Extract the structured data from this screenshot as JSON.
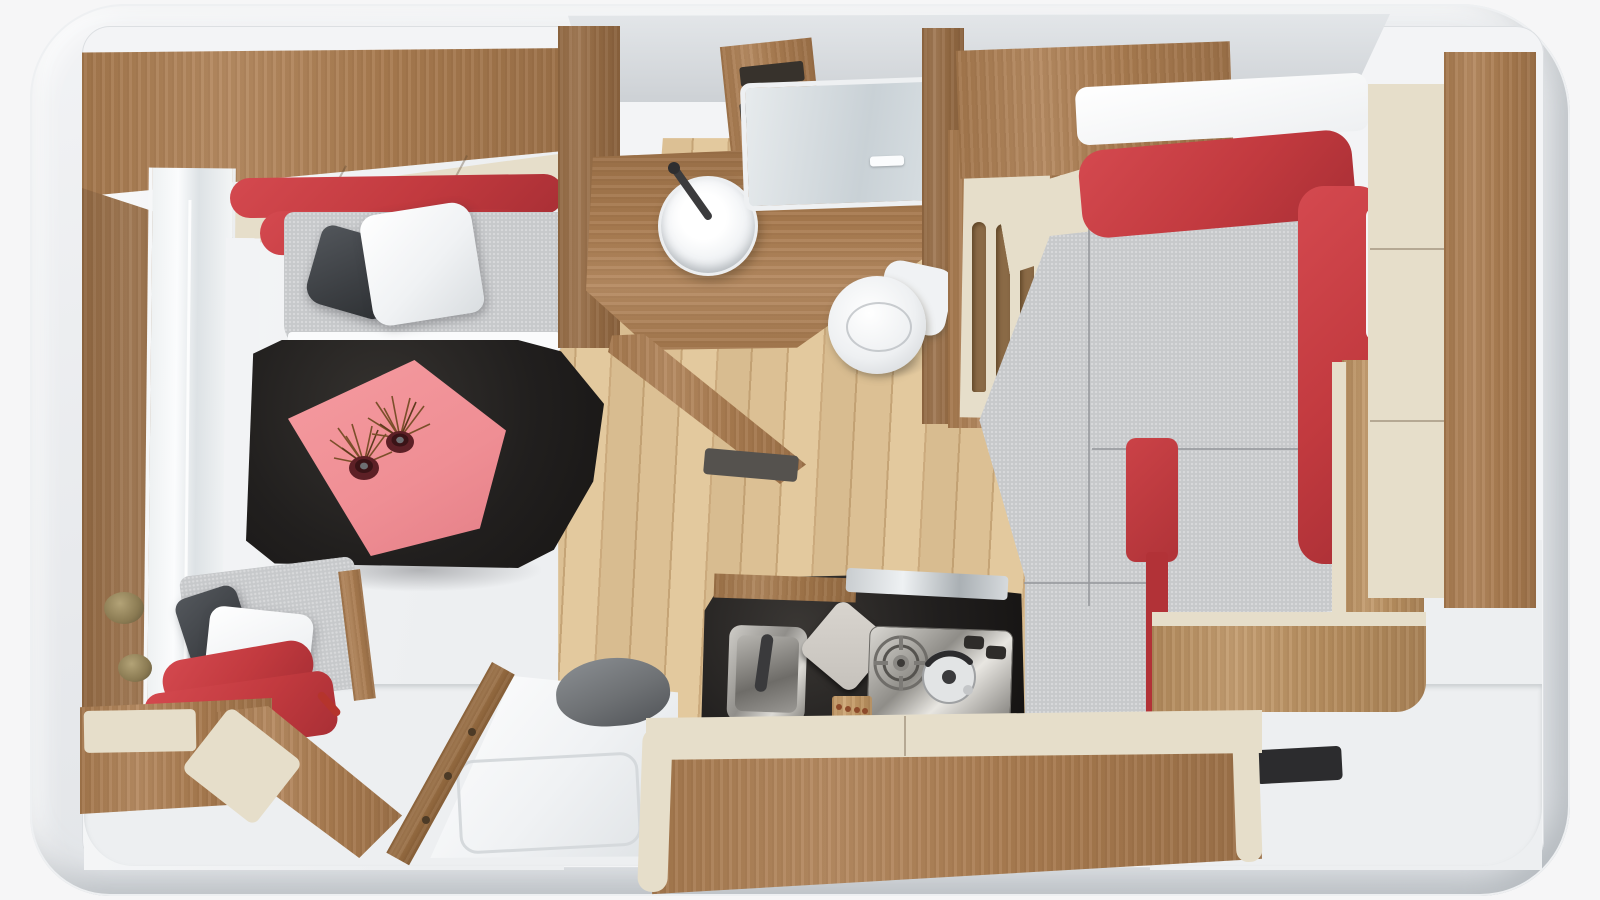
{
  "scene": {
    "label": "caravan-interior-top-down-render",
    "view": "top-down cutaway 3D render",
    "regions": {
      "lounge": {
        "label": "front dinette lounge with two facing bench seats and table",
        "objects": [
          "overhead-lockers-wood",
          "overhead-locker-doors-cream",
          "front-window",
          "seat-red-backrest",
          "seat-gray-cushion",
          "pillow-dark-gray",
          "pillow-white",
          "black-table",
          "pink-tablecloth",
          "dried-plant-pots"
        ]
      },
      "bathroom": {
        "label": "washroom with round basin, opening window and toilet",
        "objects": [
          "wood-vanity",
          "round-white-basin",
          "black-faucet",
          "window-with-latches",
          "white-toilet",
          "open-wood-door",
          "mirror-panel",
          "vent-shelf"
        ]
      },
      "kitchen": {
        "label": "galley kitchen with black worktop",
        "objects": [
          "black-worktop",
          "stainless-sink",
          "folded-faucet",
          "gray-cutting-board",
          "gas-burner",
          "kettle",
          "control-knobs",
          "spice-rack",
          "wood-bench-seat"
        ]
      },
      "bedroom": {
        "label": "rear bed with gray mattress cushions and red corner backrest",
        "objects": [
          "gray-mattress",
          "red-corner-backrest",
          "white-bedding",
          "step-ladder-panel",
          "overhead-lockers",
          "bed-platform-trim",
          "dark-floor-mat"
        ]
      },
      "wardrobe": {
        "label": "tall wardrobe with cream doors",
        "objects": [
          "cream-doors",
          "wood-side-panel"
        ]
      },
      "entry": {
        "label": "entrance with open door",
        "objects": [
          "open-entry-door",
          "door-window-frame",
          "gray-dome-cover",
          "hinge-rail",
          "step-bench-cream-pads"
        ]
      },
      "shell": {
        "label": "white caravan body shell, roof cut away",
        "objects": [
          "rounded-body",
          "roof-band"
        ]
      }
    }
  },
  "palette": {
    "shell": "#e9ebee",
    "roofGray": "#d6d9dc",
    "wallWhite": "#f3f4f6",
    "floorWhite": "#edeff1",
    "woodMid": "#b08256",
    "woodDark": "#9a7049",
    "woodLight": "#c09767",
    "woodFloor": "#dcc094",
    "woodFloorDark": "#c5a476",
    "fabricRed": "#c23a3f",
    "fabricRedLight": "#d4494f",
    "fabricRedDark": "#a92f35",
    "fabricGray": "#c7c9cb",
    "fabricGrayDark": "#babcbe",
    "cream": "#e6deca",
    "tableBlack": "#211f1e",
    "clothPink": "#ef8e94",
    "pillowDark": "#3c3f43",
    "pillowWhite": "#f0f2f4",
    "dome": "#6e7174",
    "steelDark": "#8f8d88",
    "plantBrown": "#7b4f2a",
    "potMaroon": "#5d2026"
  }
}
